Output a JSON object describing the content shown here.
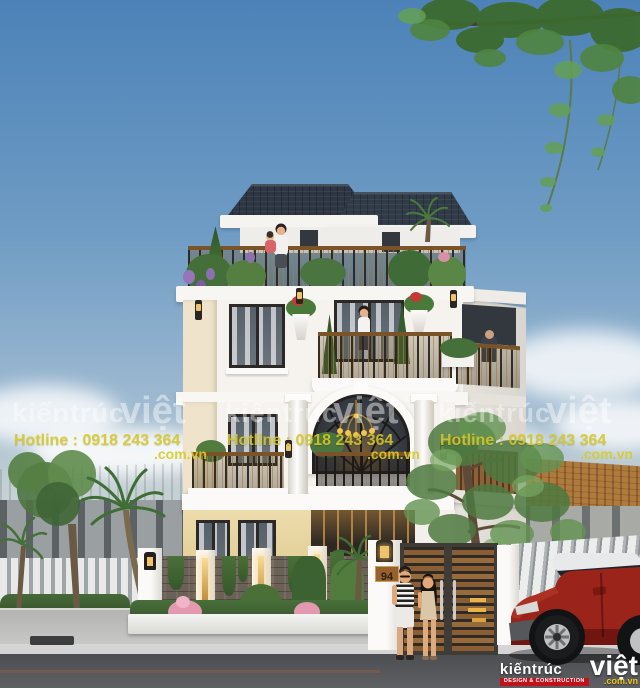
{
  "brand": {
    "name_first": "kiếntrúc",
    "name_second": "việt",
    "tagline": "DESIGN & CONSTRUCTION",
    "domain": ".com.vn"
  },
  "watermark": {
    "brand_first": "kiếntrúc",
    "brand_second": "việt",
    "hotline": "Hotline : 0918 243 364",
    "domain": ".com.vn"
  },
  "house": {
    "number": "94"
  },
  "colors": {
    "sky_top": "#4e84b9",
    "roof": "#2d3642",
    "wall_white": "#f6f3ef",
    "accent_cream": "#efe4cb",
    "accent_yellow": "#e7d7a2",
    "railing_gold": "#8a6d35",
    "gate_wood": "#8a5d32",
    "car_red": "#9b241a",
    "watermark_yellow": "#d8ca26",
    "logo_red": "#c1121c"
  }
}
